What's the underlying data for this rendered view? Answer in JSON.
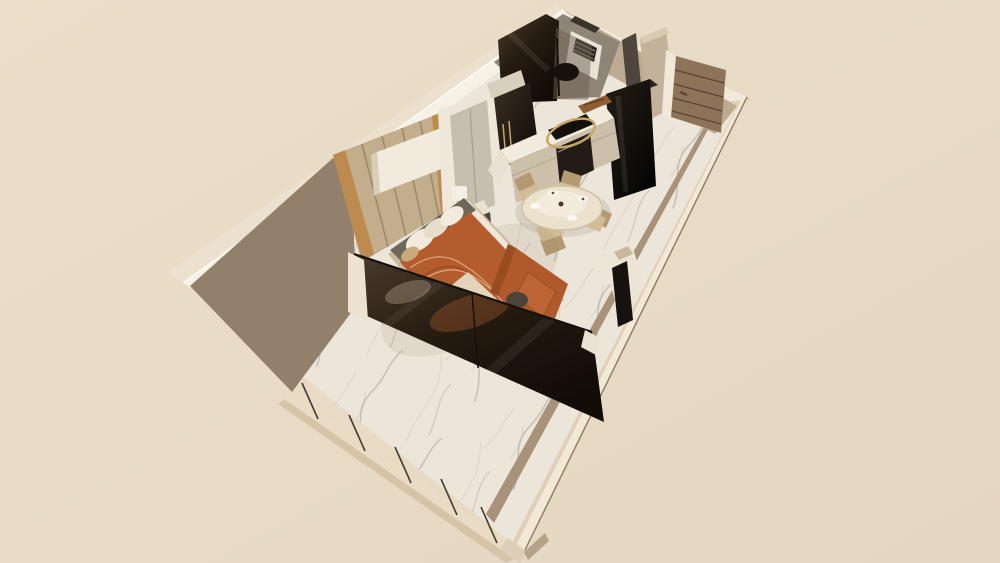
{
  "scene": {
    "kind": "3d-apartment-floorplan-render",
    "view": "aerial-axonometric",
    "rooms": [
      "bathroom",
      "kitchen",
      "dining-area",
      "bedroom",
      "entry",
      "balcony"
    ],
    "furniture": [
      "shower",
      "window-louvers",
      "refrigerator",
      "kitchen-counter",
      "induction-hob",
      "ring-pendant-lamp",
      "sink",
      "dining-table",
      "dining-chairs",
      "wardrobe",
      "wood-accent-wall",
      "shelf-box",
      "nightstand",
      "table-lamp",
      "bed",
      "pillows",
      "sofa",
      "tv-console",
      "tv",
      "glass-partition",
      "entry-door",
      "entry-closet",
      "balcony-parapet"
    ]
  },
  "palette": {
    "bg1": "#ebdfca",
    "bg2": "#e5d6bf",
    "nwOuterFace": "#ece1cf",
    "nwTopStrip": "#f6f1e6",
    "nwEdge": "#fdfaf3",
    "neOuterFace": "#d2c1a6",
    "neTopStrip": "#f1eadb",
    "seTopStrip": "#f1e8d6",
    "seFace": "#decfb6",
    "seInner": "#a8937a",
    "seEdge": "#8a7a62",
    "neInner": "#bcab91",
    "taupeWall": "#93806b",
    "marbleBase": "#ece6da",
    "marbleVein": "#bdb5a9",
    "marbleVein2": "#d6cfc3",
    "parapetTop": "#e9dbc4",
    "parapetOuter": "#d5c4a8",
    "mullion": "#453c30",
    "whitePost": "#ebe2d1",
    "cornerPost": "#ddcfb7",
    "cornerSide": "#b4a388",
    "bathWall": "#8e8577",
    "bathDark": "#3b342a",
    "windowFrame": "#e9e3d6",
    "louver": "#2c2722",
    "louverLine": "#8a8478",
    "glassTint": "#6b5e50",
    "fixture": "#17110b",
    "doorSlot": "#4e463c",
    "closet": "#c3b299",
    "closetTop": "#d8c9b2",
    "doorFrame": "#f0e9da",
    "door": "#8d7458",
    "doorGroove": "#5a4633",
    "gold": "#c8a668",
    "halfTop": "#d9cfbd",
    "halfFront": "#b9ab95",
    "wood": "#c2ae8c",
    "woodLine": "#a08a64",
    "woodTan": "#bd8b4f",
    "shelf": "#f1eadd",
    "shelfSide": "#d8cebc",
    "pillar": "#efe8da",
    "wardrobe": "#c8beaf",
    "wardrobeTop": "#dbd2c4",
    "wardrobeLine": "#a79d8e",
    "glossA": "#3a2e22",
    "glossB": "#0d0906",
    "fridgeA": "#241d14",
    "fridgeB": "#060404",
    "fridgeTop": "#2b241b",
    "counterTop": "#f2ecdf",
    "counterReturn": "#e9e1d2",
    "counterFront": "#cdc0aa",
    "counterLine": "#b3a68f",
    "oven": "#221c15",
    "ovenHandle": "#8c8273",
    "hob": "#14100b",
    "sink": "#8f5e33",
    "sinkLine": "#5f3c1e",
    "shadow": "#8a7b66",
    "tableTop": "#ebe1cd",
    "tableTier": "#f3ecdd",
    "tableEdge": "#d0c1a8",
    "chair": "#d2bc96",
    "chairDark": "#b49a72",
    "plate": "#fbf8f1",
    "food": "#6b5138",
    "tableDot": "#4a3b2c",
    "bedBase": "#c9b89c",
    "sheet": "#efe8da",
    "headboard": "#6f675b",
    "headboardLine": "#5a5347",
    "pillow": "#f2ebdd",
    "pillow2": "#e7ddcb",
    "pillowTan": "#c8a87c",
    "duvet": "#b45c2e",
    "duvetLight": "#e2b184",
    "duvetDark": "#8a431f",
    "blanket": "#e6d9c2",
    "sofa": "#b05a2b",
    "sofaSeat": "#bc6434",
    "sofaBack": "#984c22",
    "throw": "#4c443a",
    "nsTop": "#e8e0d1",
    "nsFront": "#55483a",
    "lamp": "#f4efe4",
    "consoleTop": "#ece4d5",
    "consolePad": "#cbb89c",
    "tv": "#16120d",
    "glassA": "#4a3b2c",
    "glassB": "#241a10",
    "glassC": "#120c07",
    "glassFrame": "#15100a",
    "reflOrange": "#b2622f",
    "reflCream": "#d9cab0",
    "streak": "#ffffff"
  }
}
